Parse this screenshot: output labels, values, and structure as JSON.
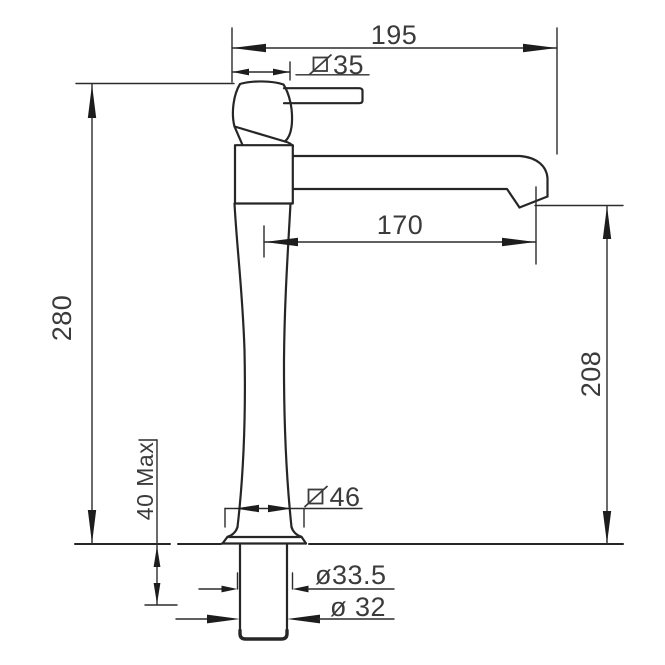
{
  "drawing": {
    "type": "technical-dimension-drawing",
    "subject": "tall basin mixer tap - side elevation with installation dimensions",
    "colors": {
      "line": "#262626",
      "dimension_line": "#2c2c2c",
      "text": "#3b3b3b",
      "background": "#ffffff"
    },
    "dimensions": {
      "overall_width": {
        "label": "195"
      },
      "handle_diameter": {
        "symbol": "square-slash-diameter",
        "value": "35"
      },
      "spout_reach": {
        "label": "170"
      },
      "overall_height": {
        "label": "280"
      },
      "spout_height": {
        "label": "208"
      },
      "deck_thickness": {
        "label": "40 Max"
      },
      "base_diameter": {
        "symbol": "square-slash-diameter",
        "value": "46"
      },
      "shank_diameter": {
        "label": "ø33.5"
      },
      "inlet_diameter": {
        "label": "ø 32"
      }
    }
  }
}
